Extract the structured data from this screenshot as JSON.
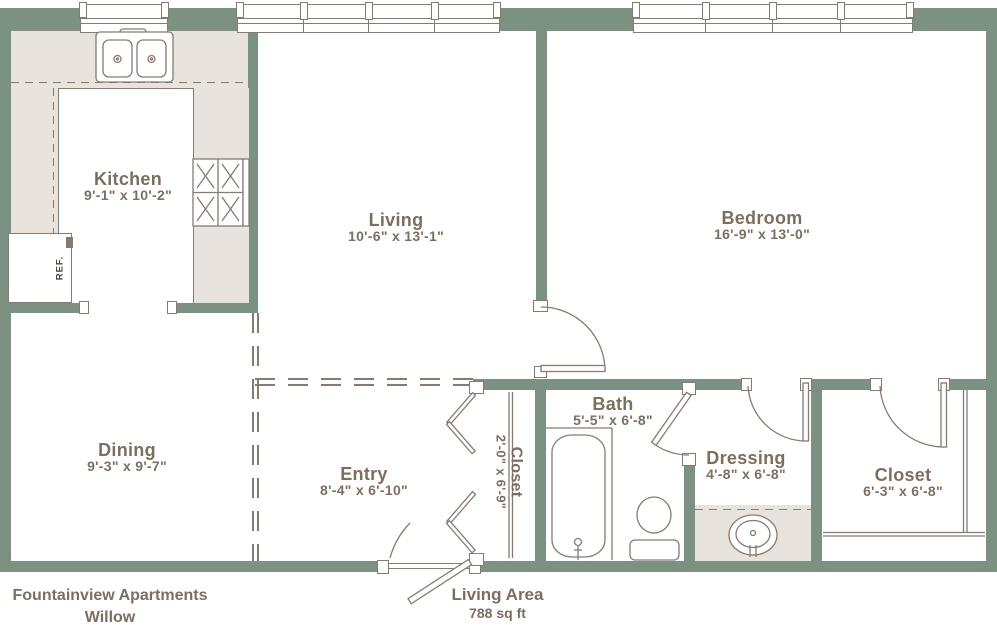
{
  "title": "Fountainview Apartments",
  "subtitle": "Willow",
  "area": {
    "label": "Living Area",
    "value": "788 sq ft"
  },
  "rooms": [
    {
      "name": "Kitchen",
      "dims": "9'-1\" x 10'-2\""
    },
    {
      "name": "Living",
      "dims": "10'-6\" x 13'-1\""
    },
    {
      "name": "Bedroom",
      "dims": "16'-9\" x 13'-0\""
    },
    {
      "name": "Dining",
      "dims": "9'-3\" x 9'-7\""
    },
    {
      "name": "Entry",
      "dims": "8'-4\" x 6'-10\""
    },
    {
      "name": "Closet",
      "dims": "2'-0\" x 6'-9\""
    },
    {
      "name": "Bath",
      "dims": "5'-5\" x 6'-8\""
    },
    {
      "name": "Dressing",
      "dims": "4'-8\" x 6'-8\""
    },
    {
      "name": "Closet",
      "dims": "6'-3\" x 6'-8\""
    }
  ],
  "fixtures": {
    "refrigerator_label": "REF."
  },
  "colors": {
    "wall": "#7b9181",
    "counter": "#e8e3dd",
    "line": "#8a7a6e",
    "text": "#7d6e5f"
  }
}
